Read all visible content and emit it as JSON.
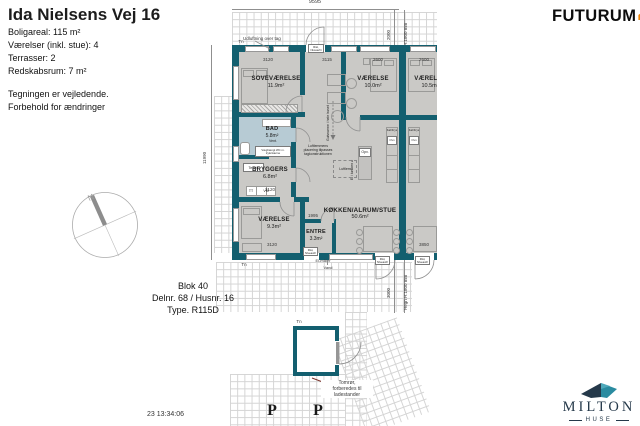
{
  "info": {
    "title": "Ida Nielsens Vej 16",
    "specs": [
      "Boligareal: 115 m²",
      "Værelser (inkl. stue): 4",
      "Terrasser: 2",
      "Redskabsrum: 7 m²"
    ],
    "notes": [
      "Tegningen er vejledende.",
      "Forbehold for ændringer"
    ]
  },
  "brand": {
    "futurum": "FUTURUM",
    "milton": "MILTON",
    "milton_sub": "HUSE"
  },
  "block": {
    "line1": "Blok 40",
    "line2": "Delnr. 68 / Husnr. 16",
    "line3": "Type. R115D"
  },
  "timestamp": "23 13:34:06",
  "rooms": {
    "sove": {
      "name": "SOVEVÆRELSE",
      "area": "11.9m²"
    },
    "v1": {
      "name": "VÆRELSE",
      "area": "10.0m²"
    },
    "v2": {
      "name": "VÆRELSE",
      "area": "10.5m²"
    },
    "bad": {
      "name": "BAD",
      "area": "5.8m²"
    },
    "bryggers": {
      "name": "BRYGGERS",
      "area": "6.8m²"
    },
    "v3": {
      "name": "VÆRELSE",
      "area": "9.3m²"
    },
    "entre": {
      "name": "ENTRE",
      "area": "3.3m²"
    },
    "stue": {
      "name": "KØKKEN/ALRUM/STUE",
      "area": "50.6m²"
    }
  },
  "dims": {
    "top": "9595",
    "left": "11990",
    "right_top": "2000",
    "right_bottom": "3000",
    "hegn": "Hegn H:1800 mm",
    "sove_w": "3120",
    "stue_w": "3115",
    "v1_w": "2600",
    "v2_w": "2600",
    "bryggers_w": "3120",
    "v3_w": "3120",
    "entre_w": "1995",
    "n_stue_w": "3850"
  },
  "ann": {
    "udluftning": "Udluftning over tag",
    "rist1": "Rist,",
    "rist2": "Niveaufri",
    "elmaaler": "El-måler",
    "vand": "Vand",
    "tn": "Tn",
    "n": "N",
    "p": "P",
    "vent": "Vent.",
    "wc1": "Væghængt WC m.",
    "wc2": "trykcisterne",
    "teknik": "Teknik",
    "tt": "TT",
    "vm": "VM",
    "luft1": "Luftlemmens",
    "luft2": "placering tilpasses",
    "luft3": "tagkonstruktionen",
    "luftlem": "Luftlem",
    "gulvvarme": "Gulvvarme i hele huset",
    "opv": "Opv.",
    "el_o": "El i køkken ø",
    "koel": "Køl/Frys",
    "ovn": "Ovn",
    "tom1": "Tomrør,",
    "tom2": "forberedes til",
    "tom3": "ladestander"
  },
  "colors": {
    "wall": "#135f6f",
    "floor": "#cac9c6",
    "bad_floor": "#b7cbd4",
    "grid": "#d4d4d4",
    "futurum_orange": "#ee8405",
    "milton_navy": "#25394a",
    "milton_teal": "#2a8ba0"
  }
}
